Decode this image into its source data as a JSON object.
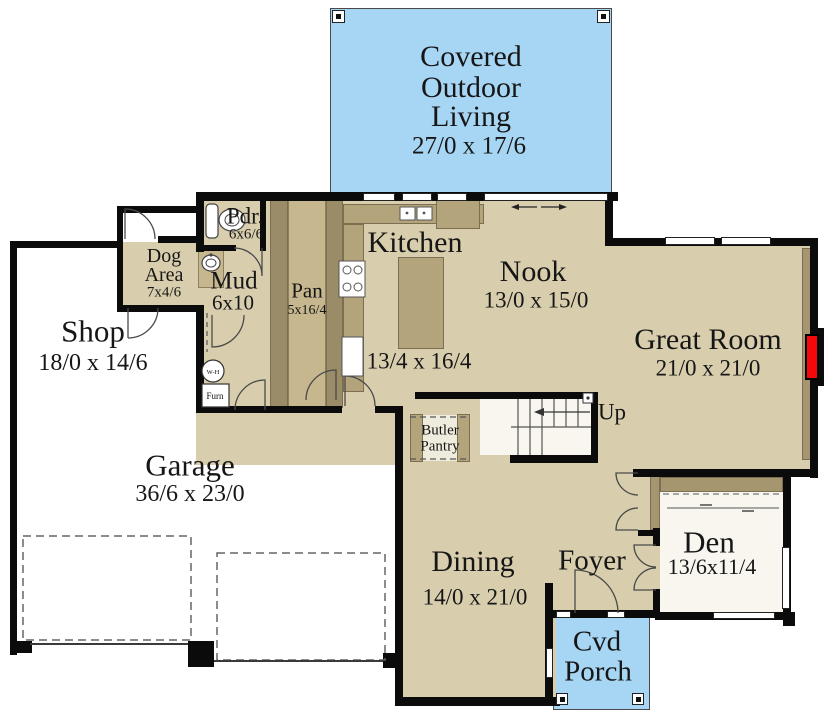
{
  "figure_type": "architectural first-floor plan",
  "colors": {
    "floor_tan": "#d8cead",
    "porch_blue": "#a7d6f4",
    "cabinet_brown": "#b4a47c",
    "wall_black": "#0b0b0b",
    "fireplace_red": "#f50808",
    "room_white": "#f8f6ef"
  },
  "rooms": {
    "covered_outdoor_living": {
      "name_lines": [
        "Covered",
        "Outdoor",
        "Living"
      ],
      "dim": "27/0 x 17/6"
    },
    "shop": {
      "name": "Shop",
      "dim": "18/0 x 14/6"
    },
    "garage": {
      "name": "Garage",
      "dim": "36/6 x 23/0"
    },
    "dog_area": {
      "name_lines": [
        "Dog",
        "Area"
      ],
      "dim": "7x4/6"
    },
    "pdr": {
      "name": "Pdr.",
      "dim": "6x6/6"
    },
    "mud": {
      "name": "Mud",
      "dim": "6x10"
    },
    "pan": {
      "name": "Pan",
      "dim": "5x16/4"
    },
    "kitchen": {
      "name": "Kitchen",
      "dim": "13/4 x 16/4"
    },
    "nook": {
      "name": "Nook",
      "dim": "13/0 x 15/0"
    },
    "great_room": {
      "name": "Great Room",
      "dim": "21/0 x 21/0"
    },
    "butler_pantry": {
      "name_lines": [
        "Butler",
        "Pantry"
      ]
    },
    "stairs": {
      "label": "Up"
    },
    "dining": {
      "name": "Dining",
      "dim": "14/0 x 21/0"
    },
    "foyer": {
      "name": "Foyer"
    },
    "den": {
      "name": "Den",
      "dim": "13/6x11/4"
    },
    "cvd_porch": {
      "name_lines": [
        "Cvd",
        "Porch"
      ]
    }
  },
  "equipment": {
    "water_heater": "W-H",
    "furnace": "Furn"
  }
}
